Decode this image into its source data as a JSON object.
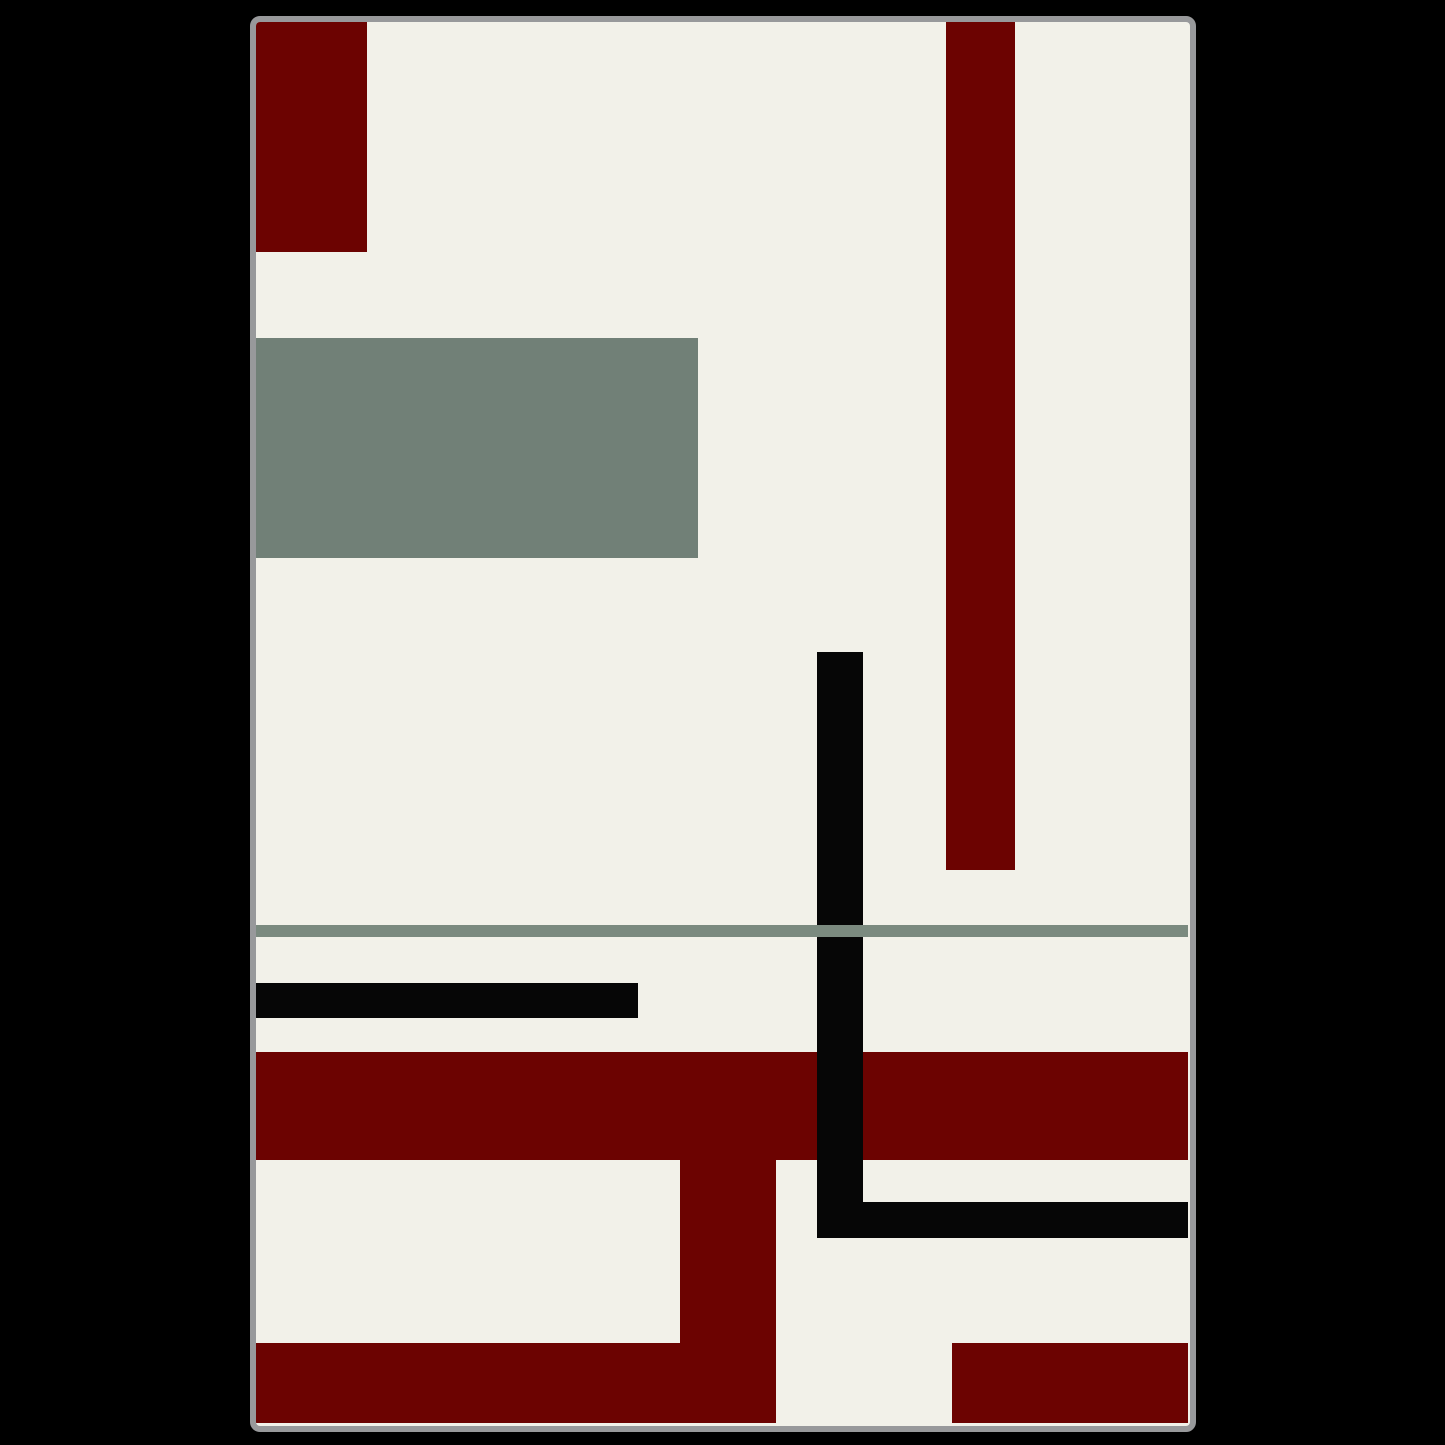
{
  "artwork": {
    "description": "abstract-geometric-art-print",
    "page_background": "#000000",
    "frame": {
      "left": 250,
      "top": 16,
      "width": 946,
      "height": 1416,
      "border_color": "#98999B",
      "border_width": 6,
      "corner_radius": 10,
      "canvas_background": "#F2F1E9"
    },
    "palette": {
      "cream": "#F2F1E9",
      "dark_red": "#6C0301",
      "sage_green": "#718077",
      "sage_line": "#7B8A7F",
      "black": "#060606"
    },
    "shapes": [
      {
        "name": "green-rectangle",
        "left": 0,
        "top": 316,
        "width": 442,
        "height": 220,
        "color": "#718077"
      },
      {
        "name": "red-top-left-rectangle",
        "left": 0,
        "top": 0,
        "width": 111,
        "height": 230,
        "color": "#6C0301"
      },
      {
        "name": "red-vertical-bar-top-right",
        "left": 690,
        "top": 0,
        "width": 69,
        "height": 848,
        "color": "#6C0301"
      },
      {
        "name": "red-horizontal-band",
        "left": 0,
        "top": 1030,
        "width": 932,
        "height": 108,
        "color": "#6C0301"
      },
      {
        "name": "red-stem-vertical",
        "left": 424,
        "top": 1138,
        "width": 96,
        "height": 263,
        "color": "#6C0301"
      },
      {
        "name": "red-bottom-left-block",
        "left": 0,
        "top": 1321,
        "width": 520,
        "height": 80,
        "color": "#6C0301"
      },
      {
        "name": "red-bottom-right-block",
        "left": 696,
        "top": 1321,
        "width": 236,
        "height": 80,
        "color": "#6C0301"
      },
      {
        "name": "black-horizontal-bar-middle",
        "left": 0,
        "top": 961,
        "width": 382,
        "height": 35,
        "color": "#060606"
      },
      {
        "name": "black-vertical-bar",
        "left": 561,
        "top": 630,
        "width": 46,
        "height": 586,
        "color": "#060606"
      },
      {
        "name": "black-horizontal-bar-bottom",
        "left": 561,
        "top": 1180,
        "width": 371,
        "height": 36,
        "color": "#060606"
      },
      {
        "name": "green-horizontal-line",
        "left": 0,
        "top": 903,
        "width": 932,
        "height": 12,
        "color": "#7B8A7F"
      }
    ]
  }
}
